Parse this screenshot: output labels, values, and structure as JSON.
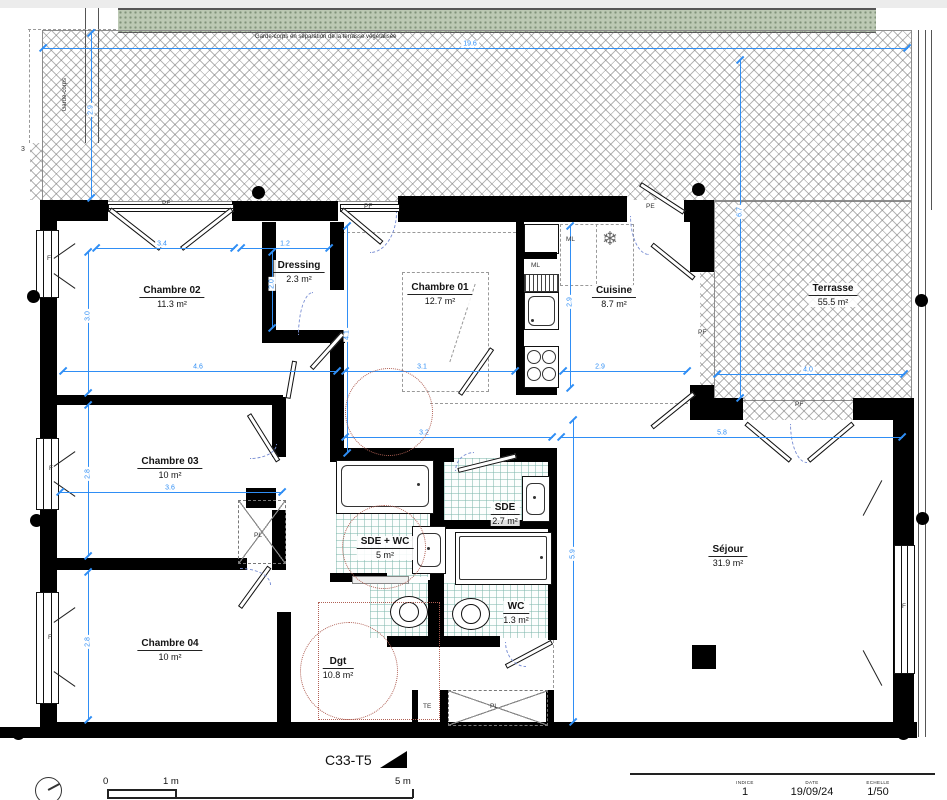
{
  "sheet": {
    "code": "C33-T5"
  },
  "notes": {
    "garde_corps_top": "Garde-corps en séparation de la terrasse végétalisée",
    "garde_corps_left": "Garde-corps",
    "level_marker": "3"
  },
  "rooms": {
    "chambre02": {
      "name": "Chambre 02",
      "area": "11.3 m²"
    },
    "dressing": {
      "name": "Dressing",
      "area": "2.3 m²"
    },
    "chambre01": {
      "name": "Chambre 01",
      "area": "12.7 m²"
    },
    "cuisine": {
      "name": "Cuisine",
      "area": "8.7 m²"
    },
    "terrasse": {
      "name": "Terrasse",
      "area": "55.5 m²"
    },
    "chambre03": {
      "name": "Chambre 03",
      "area": "10 m²"
    },
    "sde_wc": {
      "name": "SDE + WC",
      "area": "5 m²"
    },
    "sde": {
      "name": "SDE",
      "area": "2.7 m²"
    },
    "wc": {
      "name": "WC",
      "area": "1.3 m²"
    },
    "sejour": {
      "name": "Séjour",
      "area": "31.9 m²"
    },
    "chambre04": {
      "name": "Chambre 04",
      "area": "10 m²"
    },
    "dgt": {
      "name": "Dgt",
      "area": "10.8 m²"
    }
  },
  "labels": {
    "f": "F",
    "pf": "PF",
    "pe": "PE",
    "ml": "ML",
    "pl": "PL",
    "te": "TE"
  },
  "icons": {
    "snowflake": "❄"
  },
  "dims": {
    "top_width": "19.6",
    "terrace_height_left": "2.9",
    "terrace_height_right": "6.7",
    "ch02_win": "3.4",
    "dressing_w": "1.2",
    "dressing_d": "2.0",
    "ch02_h": "3.0",
    "ch02_w": "4.6",
    "ch01_w": "3.1",
    "ch01_h": "4.1",
    "cuisine_h": "2.9",
    "cuisine_w": "2.9",
    "terrace_low_w": "4.0",
    "hall_w": "3.2",
    "sejour_w": "5.8",
    "ch03_w": "3.6",
    "ch03_h": "2.8",
    "ch04_h": "2.8",
    "sejour_h": "5.9"
  },
  "scale_bar": {
    "zero": "0",
    "one": "1 m",
    "five": "5 m"
  },
  "title_block": {
    "indice_label": "INDICE",
    "indice_value": "1",
    "date_label": "DATE",
    "date_value": "19/09/24",
    "echelle_label": "ECHELLE",
    "echelle_value": "1/50"
  },
  "colors": {
    "dim_blue": "#2f8ef5",
    "wall": "#000000",
    "hatch": "#8c8c8c",
    "vegetal": "#bcc9b4",
    "tile": "#8cbeb4",
    "guide_red": "#b06055"
  }
}
